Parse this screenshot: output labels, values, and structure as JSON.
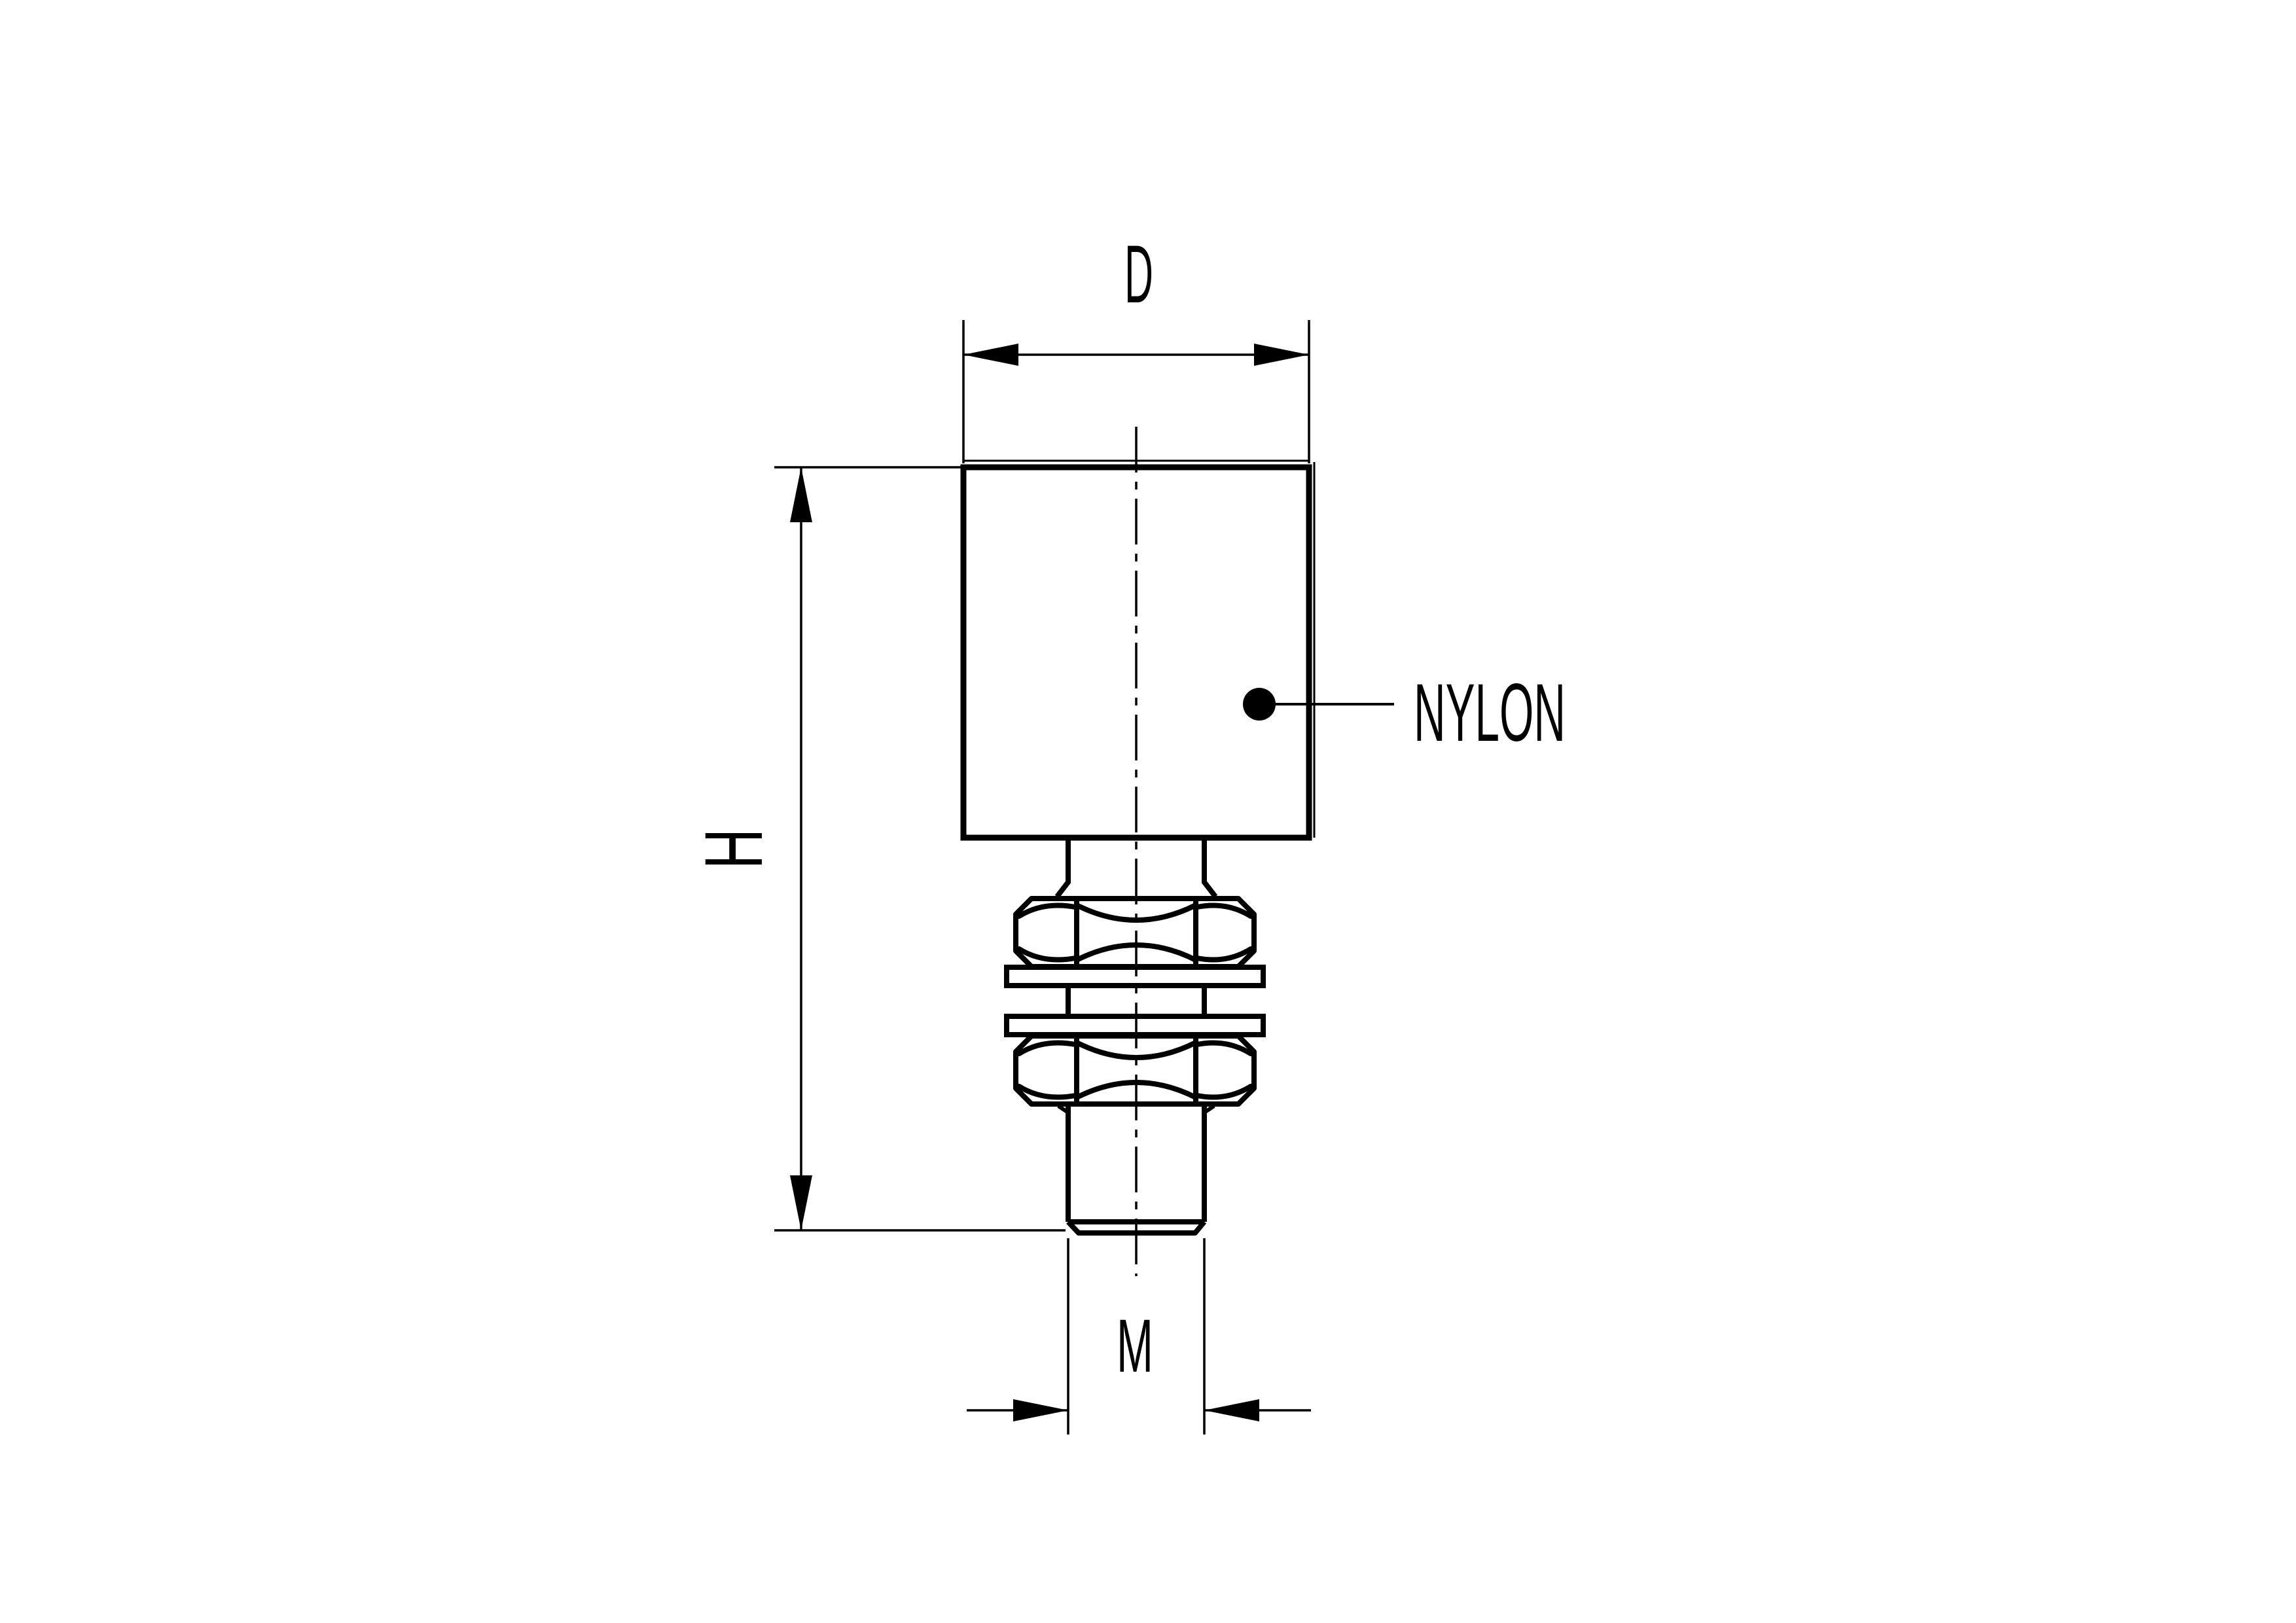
{
  "sheet": {
    "paper_color": "#ffffff",
    "ink_color": "#000000"
  },
  "drawing": {
    "type": "technical side view of nylon roller with threaded stud, two hex nuts and two washers",
    "dimensions": {
      "diameter_label": "D",
      "height_label": "H",
      "thread_label": "M"
    },
    "material_callout": {
      "label": "NYLON"
    }
  }
}
